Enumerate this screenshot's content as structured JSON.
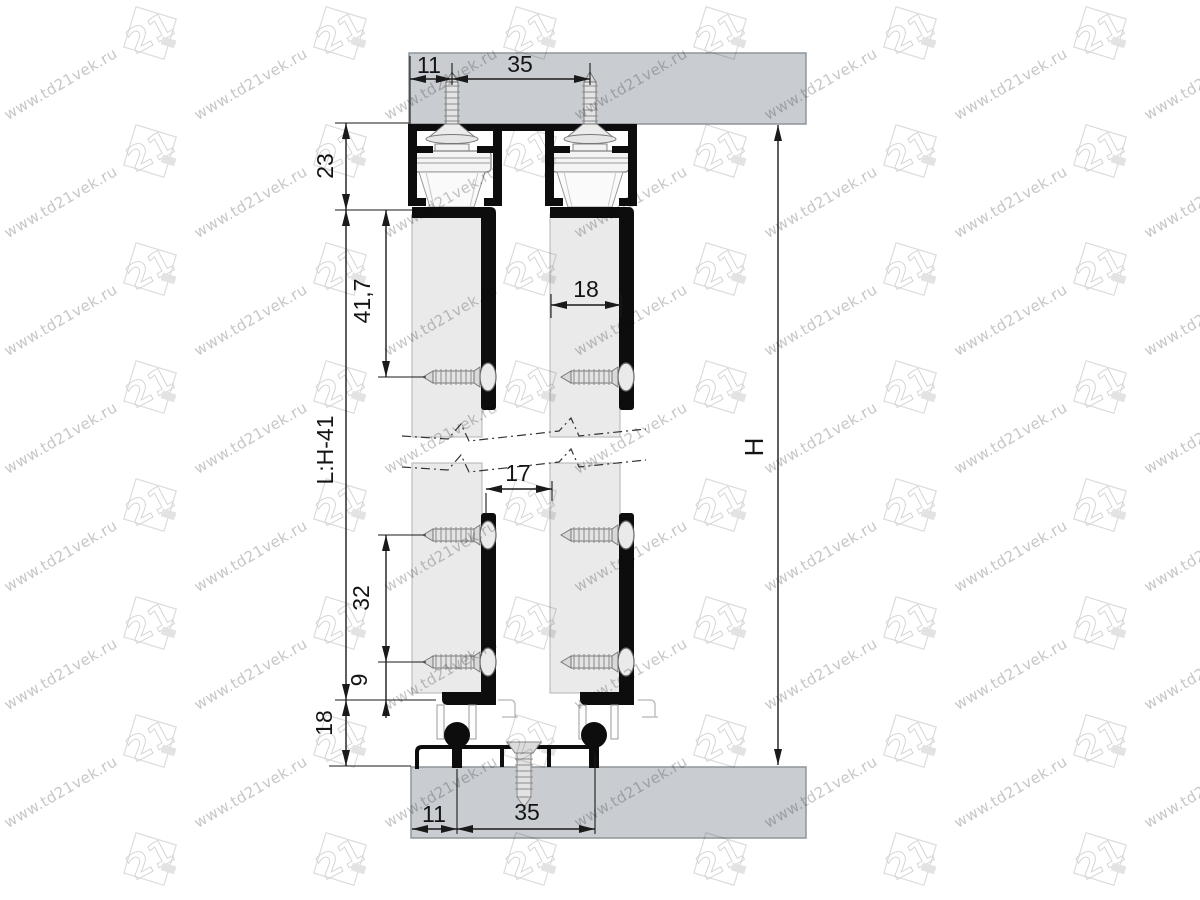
{
  "watermark": {
    "url": "www.td21vek.ru",
    "logo": "21"
  },
  "dims": {
    "top_edge_offset": "11",
    "top_screw_spacing": "35",
    "track_height": "23",
    "door_top_to_screw": "41,7",
    "door_thickness": "18",
    "door_gap": "17",
    "bottom_screw_spacing": "32",
    "bottom_screw_offset": "9",
    "bottom_clearance": "18",
    "door_height_formula": "L:H-41",
    "opening_height": "H",
    "bottom_edge_offset": "11",
    "bottom_guide_spacing": "35"
  },
  "colors": {
    "board_gray": "#c9cdd2",
    "board_edge": "#8f959a",
    "door_gray": "#eaeaea",
    "profile_black": "#0d0d0d",
    "dimension_ink": "#1a1a1a",
    "watermark_gray": "#c7c7c7"
  }
}
